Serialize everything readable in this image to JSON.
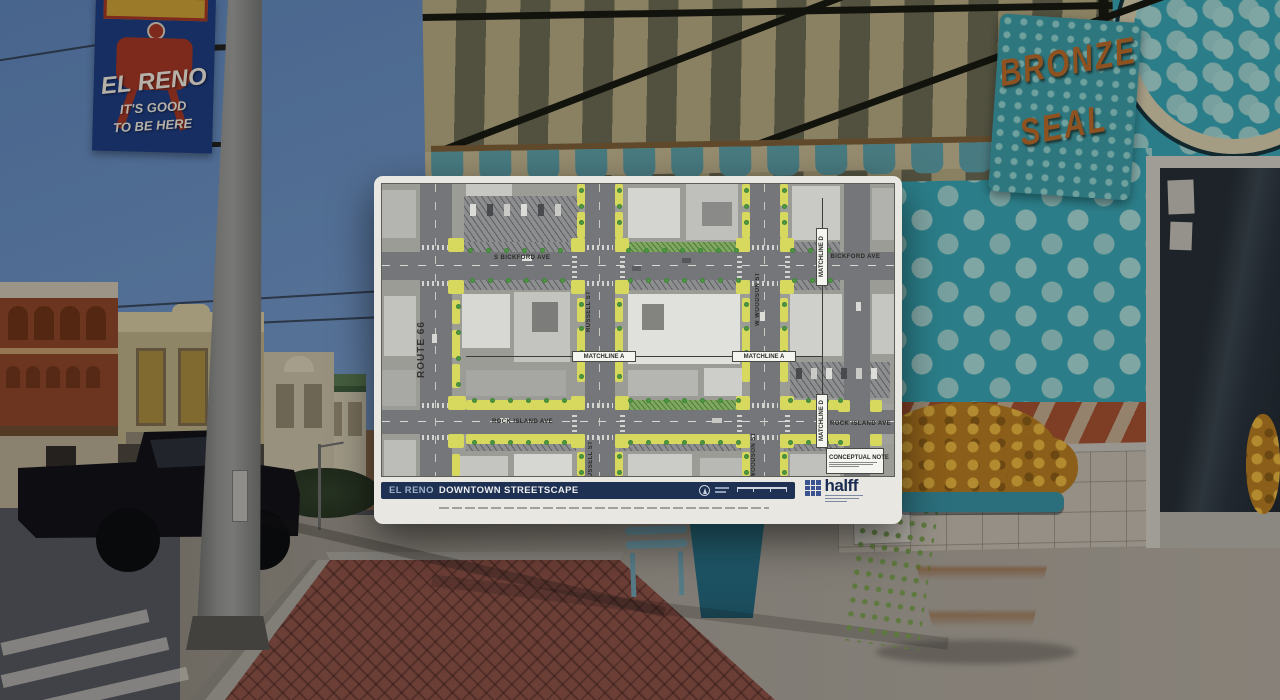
{
  "scene": {
    "street_banner": {
      "city": "EL RENO",
      "tagline_line1": "IT'S GOOD",
      "tagline_line2": "TO BE HERE"
    },
    "storefront_sign": {
      "line1": "BRONZE",
      "line2": "SEAL"
    }
  },
  "plan_board": {
    "title_city": "EL RENO",
    "title_main": "DOWNTOWN STREETSCAPE",
    "firm_logo": "halff",
    "conceptual_note_title": "CONCEPTUAL NOTE",
    "map_labels": {
      "route_66": "ROUTE 66",
      "s_bickford_ave_west": "S BICKFORD AVE",
      "s_bickford_ave_east": "S BICKFORD AVE",
      "russell_st_north": "RUSSELL ST",
      "russell_st_south": "RUSSELL ST",
      "w_woodson_st": "W WOODSON ST",
      "woodson_st": "WOODSON ST",
      "matchline_a_west": "MATCHLINE A",
      "matchline_a_east": "MATCHLINE A",
      "matchline_d_north": "MATCHLINE D",
      "matchline_d_south": "MATCHLINE D",
      "rock_island_ave_west": "ROCK ISLAND AVE",
      "rock_island_ave_east": "ROCK ISLAND AVE"
    },
    "colors": {
      "streetscape_yellow": "#d7d85e",
      "tree_green": "#57a34c",
      "titlebar_navy": "#1f3152",
      "logo_blue": "#3c5290"
    }
  }
}
